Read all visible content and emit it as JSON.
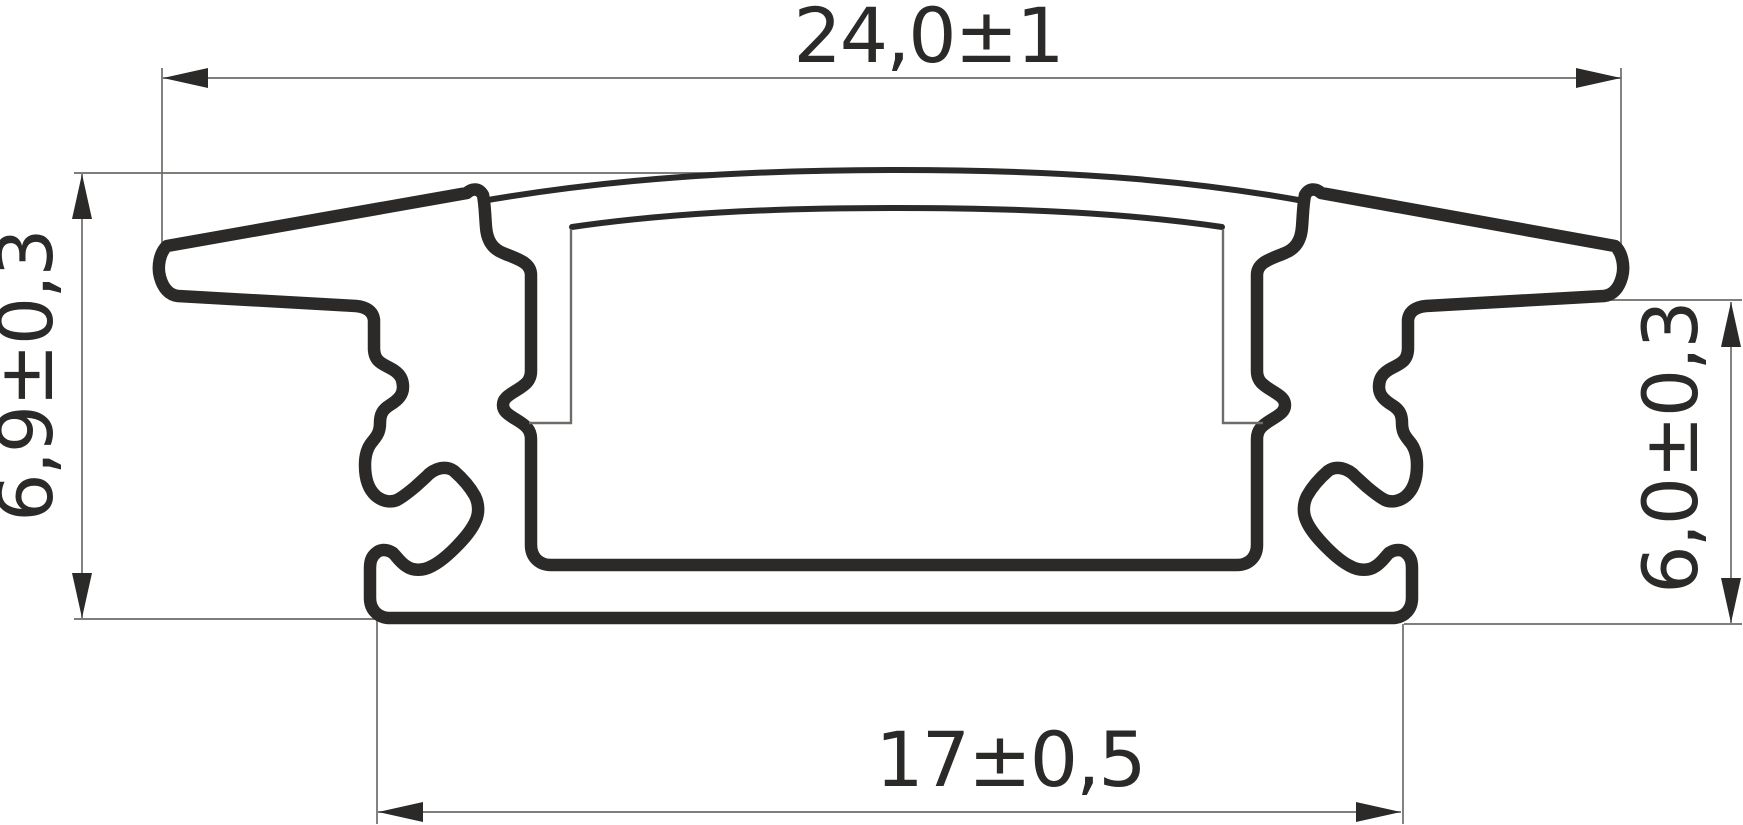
{
  "drawing": {
    "title": "LED aluminium recessed profile cross-section",
    "dimensions": {
      "top": {
        "label": "24,0±1"
      },
      "left": {
        "label": "6,9±0,3"
      },
      "right": {
        "label": "6,0±0,3"
      },
      "bottom": {
        "label": "17±0,5"
      }
    },
    "colors": {
      "line": "#2b2a29",
      "thin_line": "#6e6b68",
      "background": "#ffffff"
    }
  }
}
